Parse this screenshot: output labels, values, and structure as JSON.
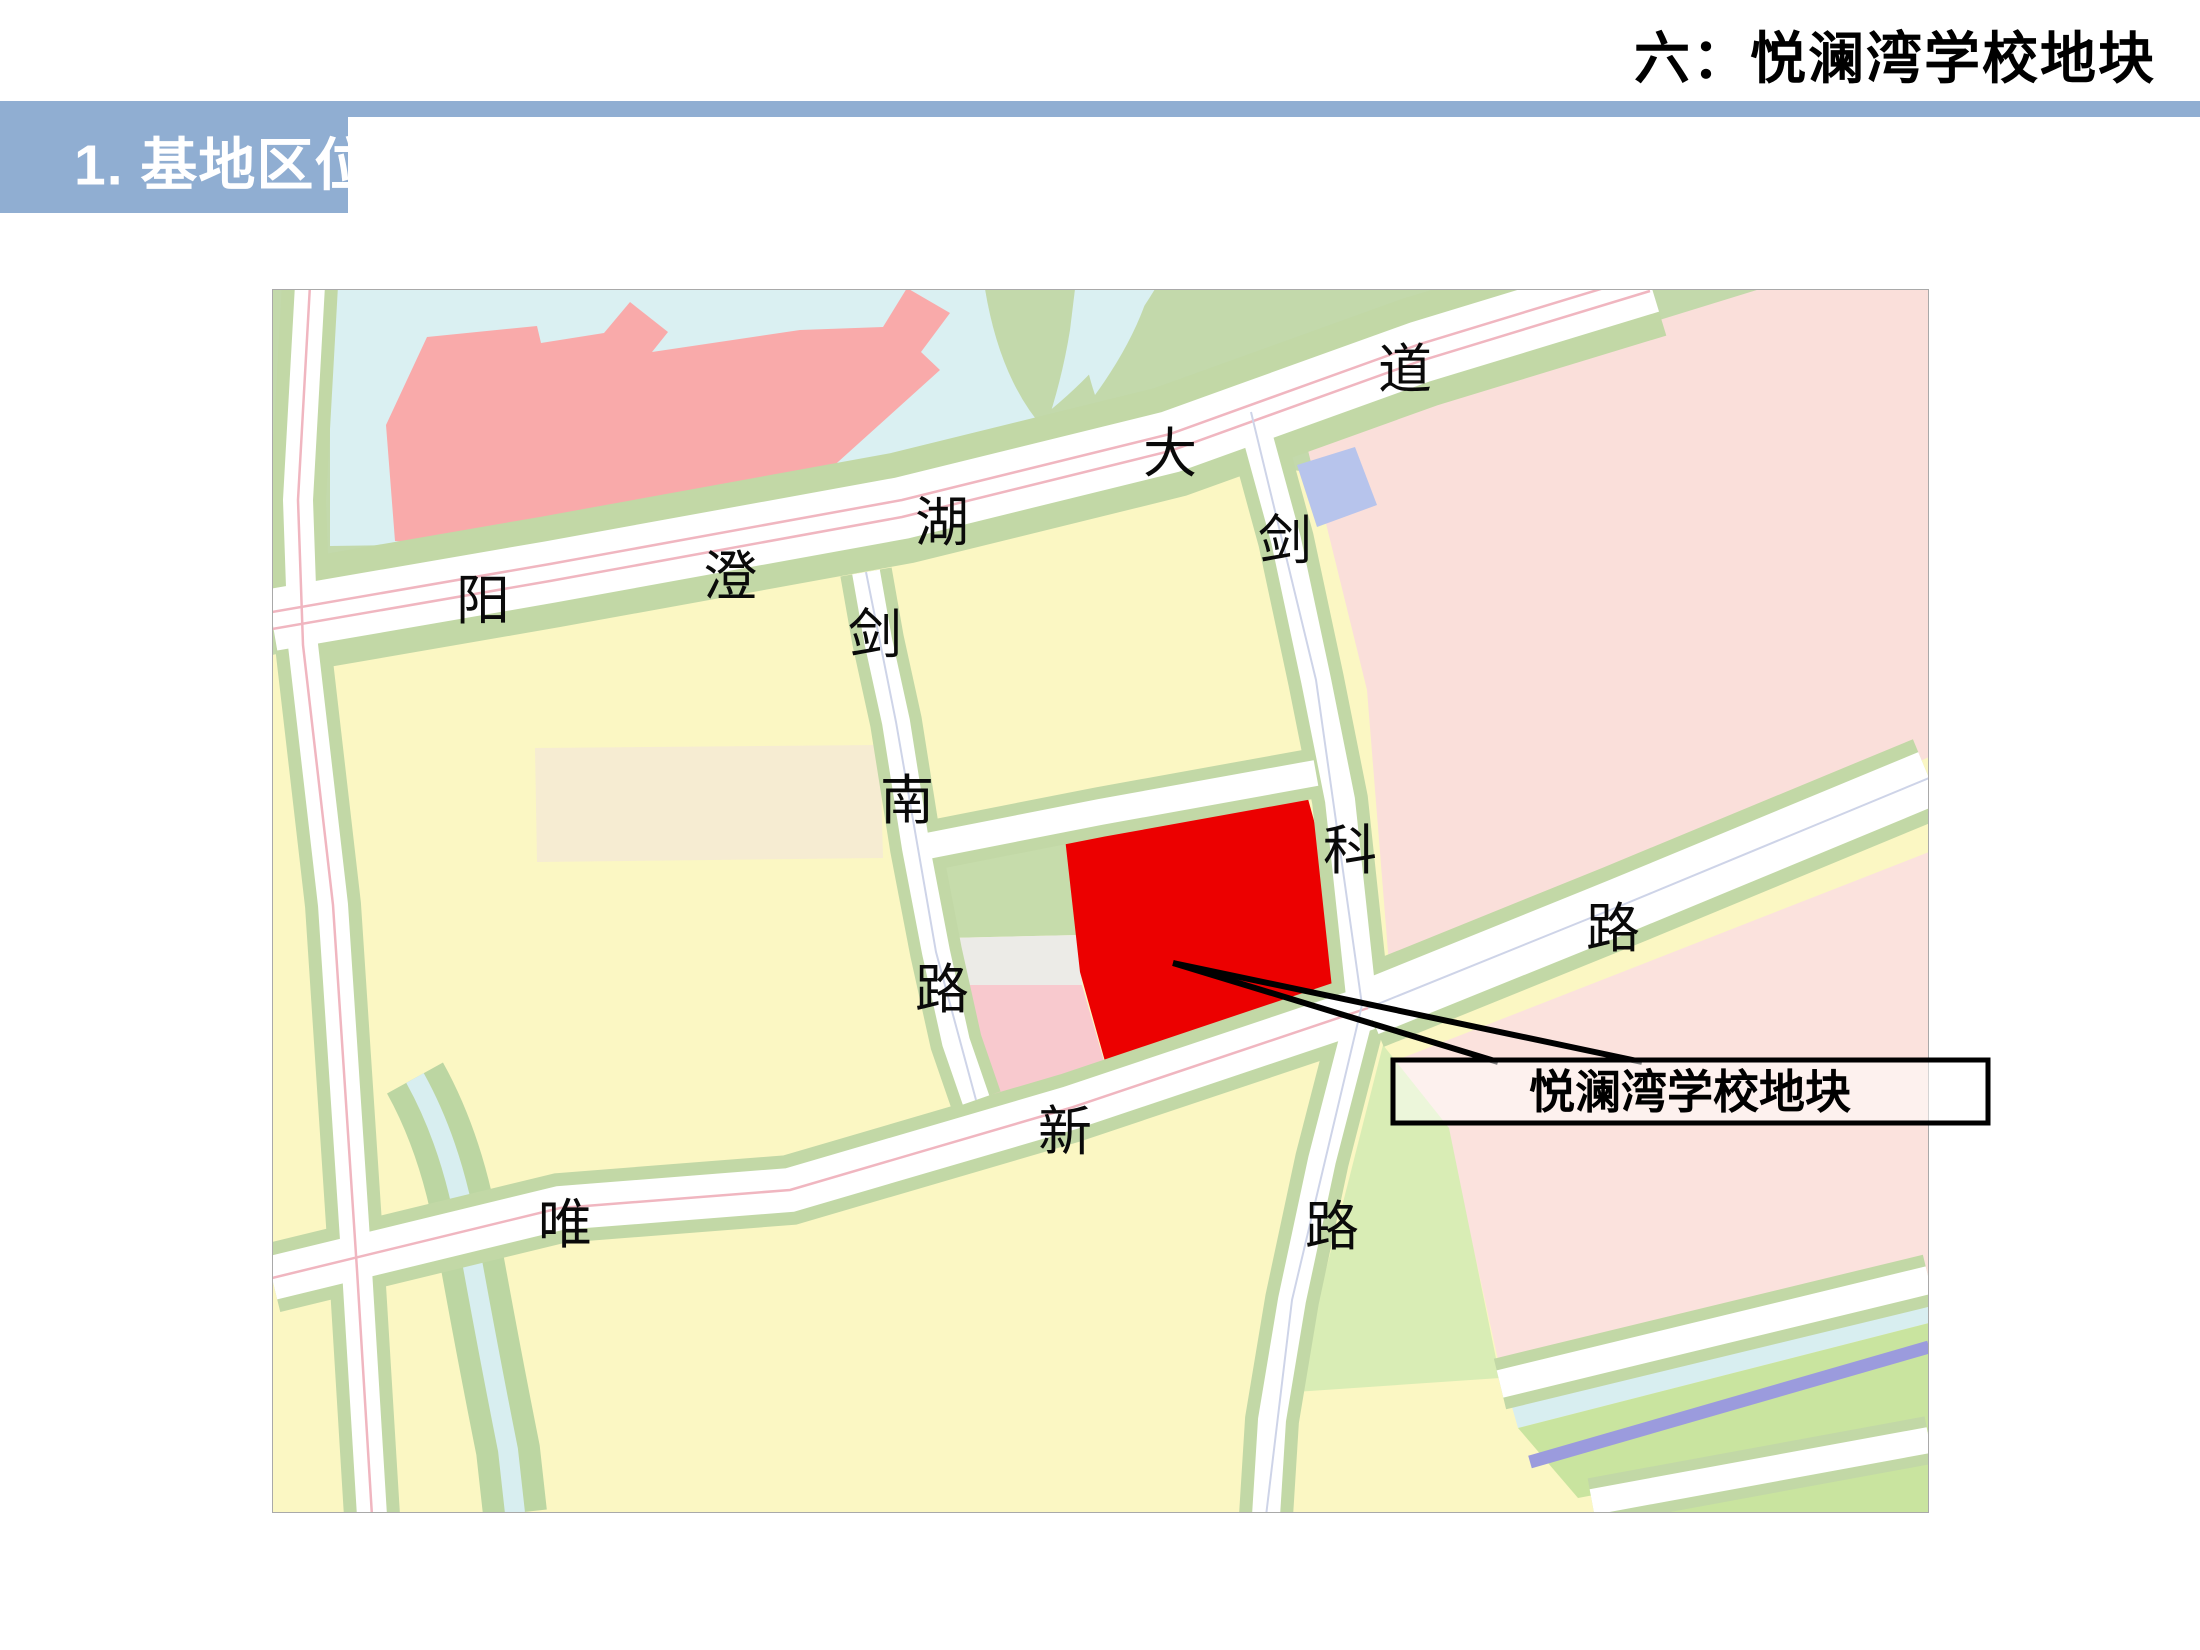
{
  "page": {
    "title": "六：悦澜湾学校地块",
    "section_label": "1. 基地区位"
  },
  "colors": {
    "accent_bar": "#90aed2",
    "water": "#daf0f2",
    "green_band": "#c3d9ab",
    "green_verge": "#c2d8a6",
    "green_light": "#d9edb5",
    "yellow_parcel": "#fbf7c3",
    "cream_parcel": "#f6ecd2",
    "pink_parcel_ne": "#fadfda",
    "pink_parcel_se": "#fbe2dd",
    "pink_small": "#f8c9ce",
    "grey_strip": "#ecebe7",
    "building_pink": "#f9aaaa",
    "blue_parcel": "#b7c4ec",
    "site_red": "#ec0000",
    "river_purple": "#9b9bdd",
    "road_centerline": "#f0b6c0"
  },
  "map": {
    "callout": {
      "text": "悦澜湾学校地块"
    },
    "labels": [
      {
        "char": "阳",
        "road": "yangchenghu-avenue"
      },
      {
        "char": "澄",
        "road": "yangchenghu-avenue"
      },
      {
        "char": "湖",
        "road": "yangchenghu-avenue"
      },
      {
        "char": "大",
        "road": "yangchenghu-avenue"
      },
      {
        "char": "道",
        "road": "yangchenghu-avenue"
      },
      {
        "char": "剑",
        "road": "jiannan-road"
      },
      {
        "char": "南",
        "road": "jiannan-road"
      },
      {
        "char": "路",
        "road": "jiannan-road"
      },
      {
        "char": "剑",
        "road": "kejian-road"
      },
      {
        "char": "科",
        "road": "kejian-road"
      },
      {
        "char": "路",
        "road": "east-road"
      },
      {
        "char": "唯",
        "road": "weixin-road"
      },
      {
        "char": "新",
        "road": "weixin-road"
      },
      {
        "char": "路",
        "road": "weixin-road"
      }
    ]
  }
}
